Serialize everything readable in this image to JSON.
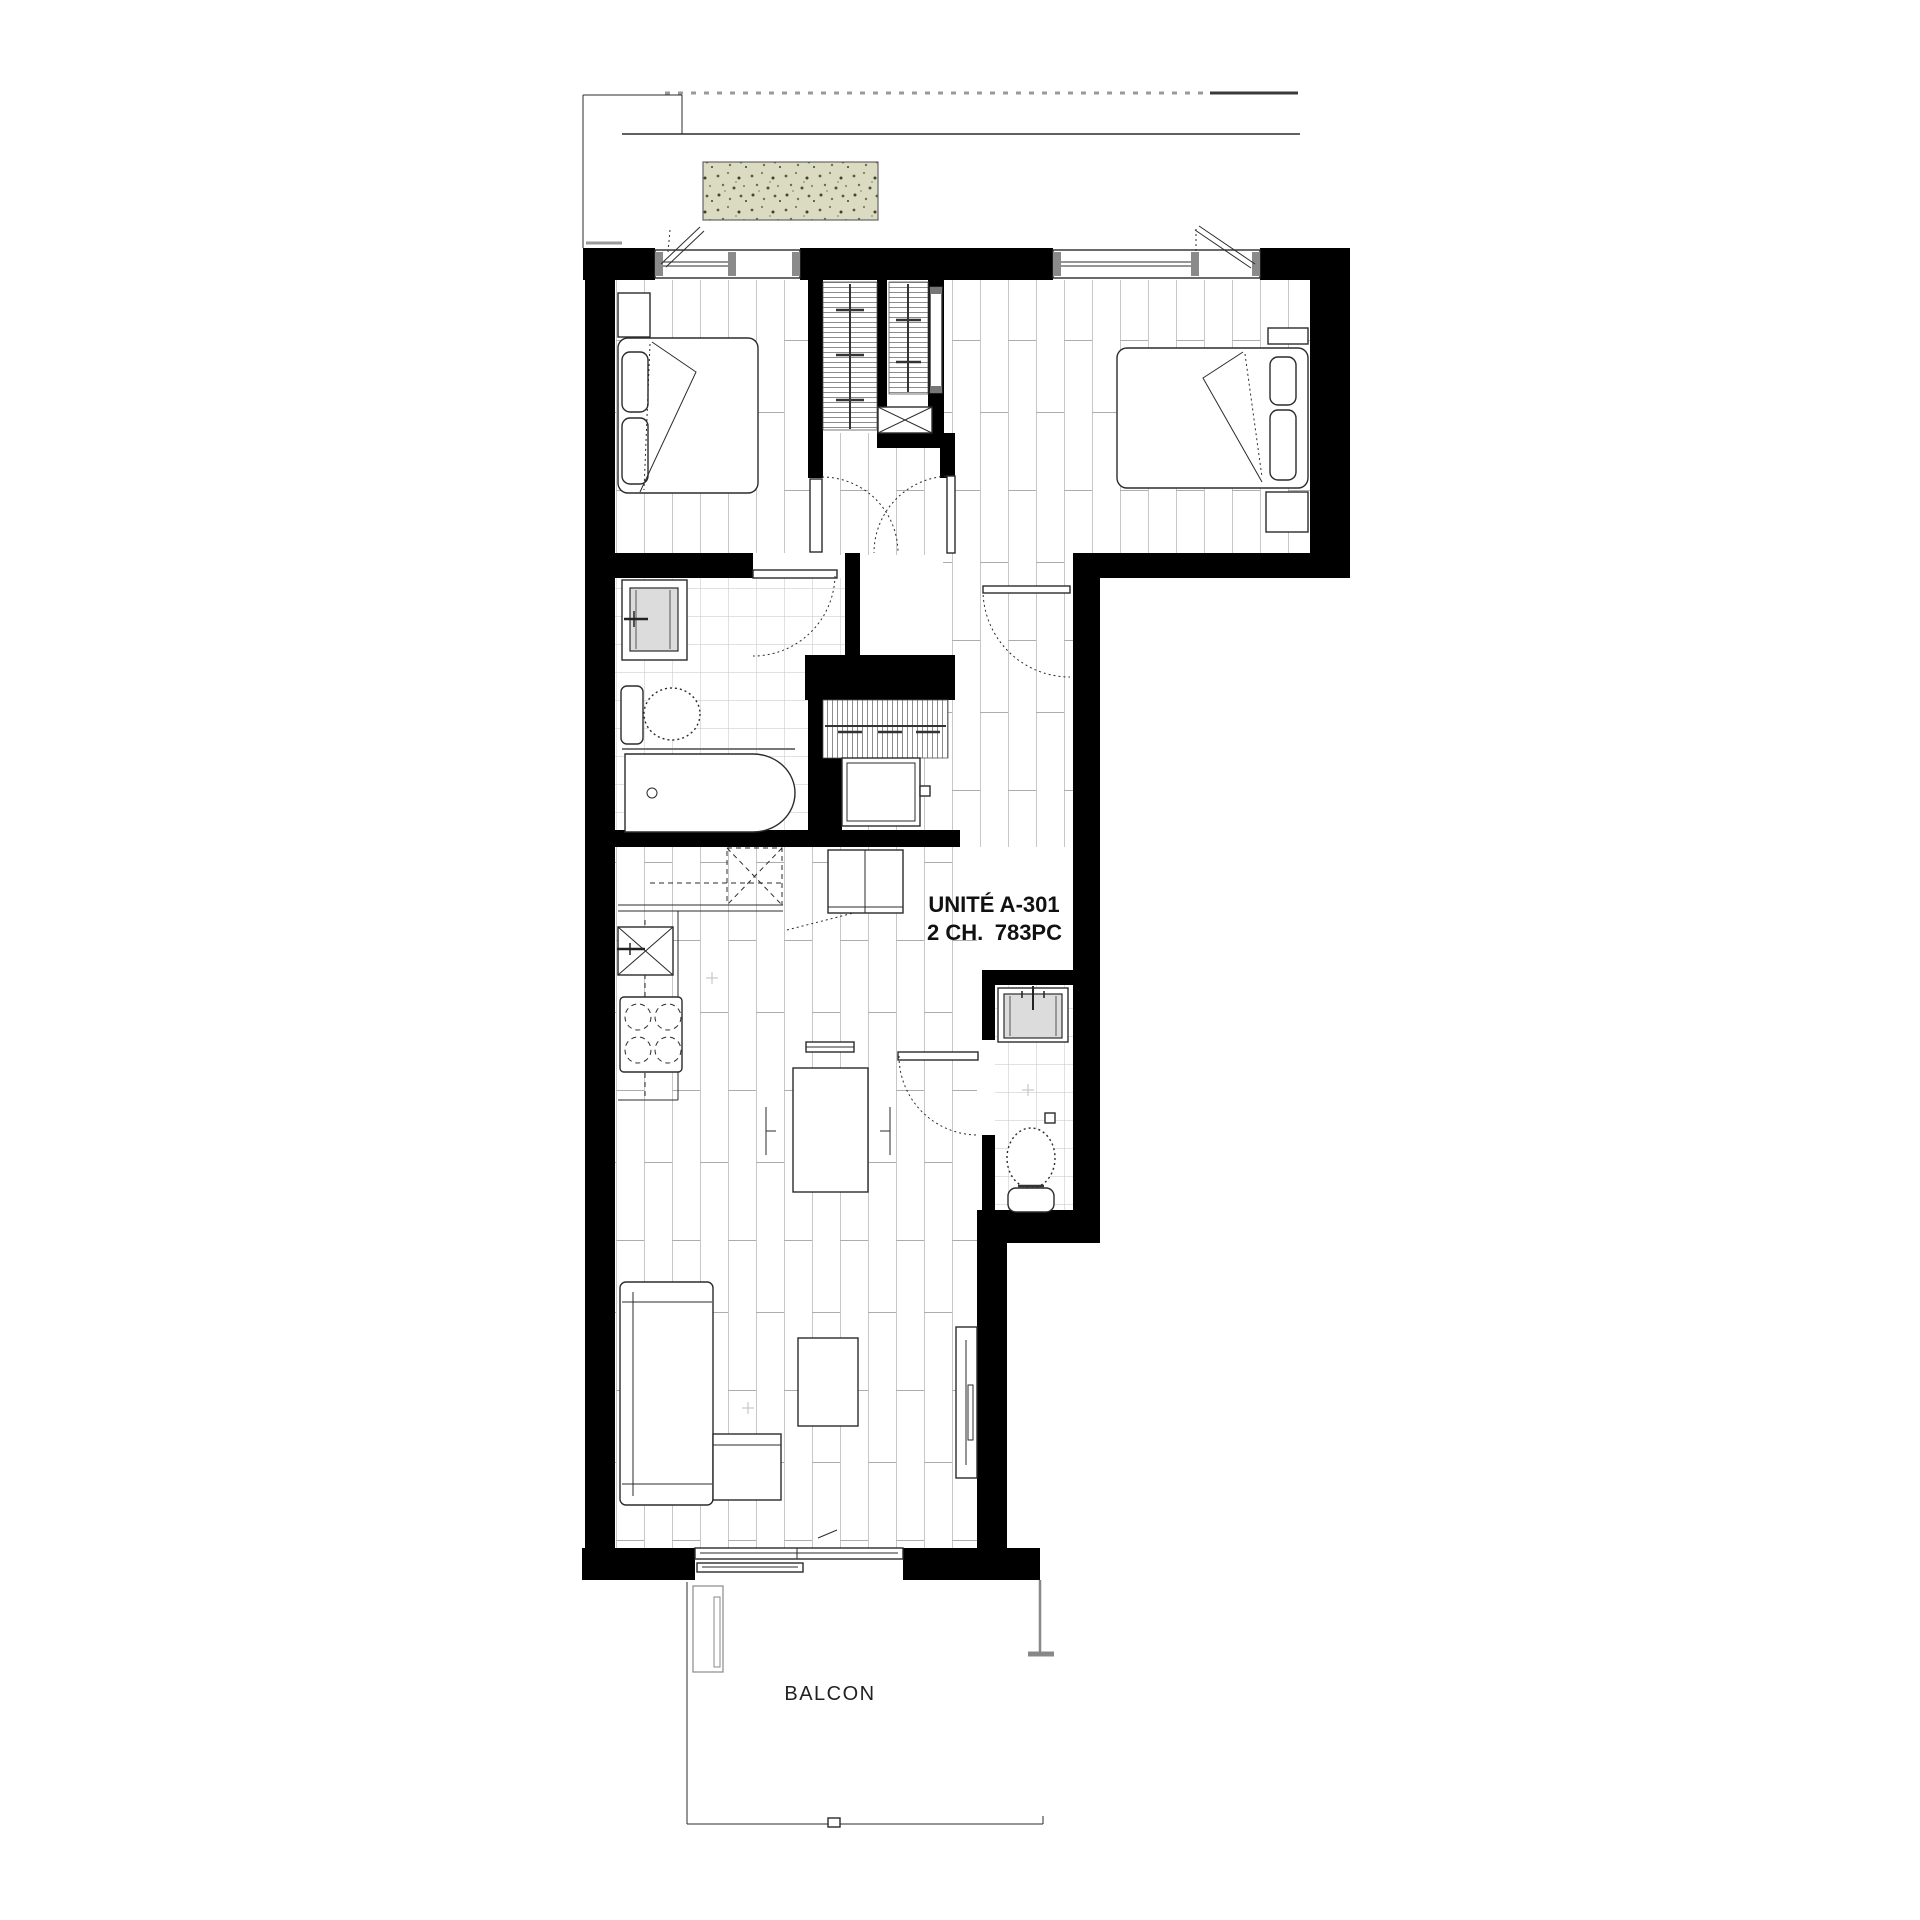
{
  "floor_plan": {
    "unit": {
      "label": "UNITÉ A-301",
      "bedrooms": "2 CH.",
      "area": "783PC"
    },
    "balcony_label": "BALCON",
    "colors": {
      "wall": "#000000",
      "line": "#2b2b2b",
      "floor-line": "#c7c7c7",
      "tile-line": "#c3c3c3",
      "planter-fill": "#dadbc0",
      "mullion": "#8a8a8a",
      "sink-fill": "#dcdcdc",
      "text": "#111111"
    }
  }
}
